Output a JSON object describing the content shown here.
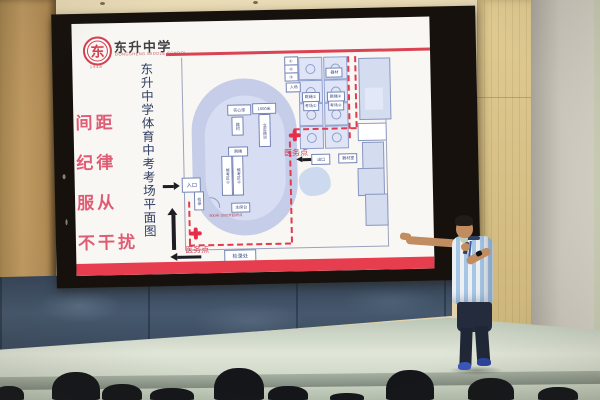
{
  "slide": {
    "logo": {
      "seal_char": "东",
      "name_cn": "东升中学",
      "name_en": "DONGSHENG MIDDLE SCHOOL",
      "year": "1948"
    },
    "motto_lines": [
      "间距",
      "纪律",
      "服从",
      "不干扰"
    ],
    "vertical_title": "东升中学体育中考考场平面图",
    "map": {
      "court_boxes": [
        "器材",
        "跳绳①",
        "跳绳②",
        "考场①",
        "考场②"
      ],
      "stand_boxes": [
        "①",
        "②",
        "③",
        "入场"
      ],
      "track_boxes": {
        "h1": "实心球",
        "h2": "1000米",
        "v1": "器材",
        "v2": "立定跳远",
        "h3": "跳绳",
        "vp1": "候考区①",
        "vp2": "候考区②",
        "hb": "主席台",
        "note": "800米·1000米起终点"
      },
      "left_boxes": {
        "entrance": "入口",
        "check": "检录"
      },
      "mid_boxes": {
        "exit": "出口",
        "equipment": "器材室"
      },
      "bottom_box": "检录处",
      "medical_label": "医务点"
    }
  },
  "colors": {
    "banner_red": "#e63d4f",
    "path_red": "#e03b50",
    "logo_red": "#d4404e",
    "motto_pink": "#e05c74",
    "title_navy": "#2f3e63",
    "map_outline_blue": "#8fa0cf",
    "track_fill": "#c5cde8",
    "slate_wall": "#46586d",
    "stage_floor": "#dfe5d8"
  }
}
